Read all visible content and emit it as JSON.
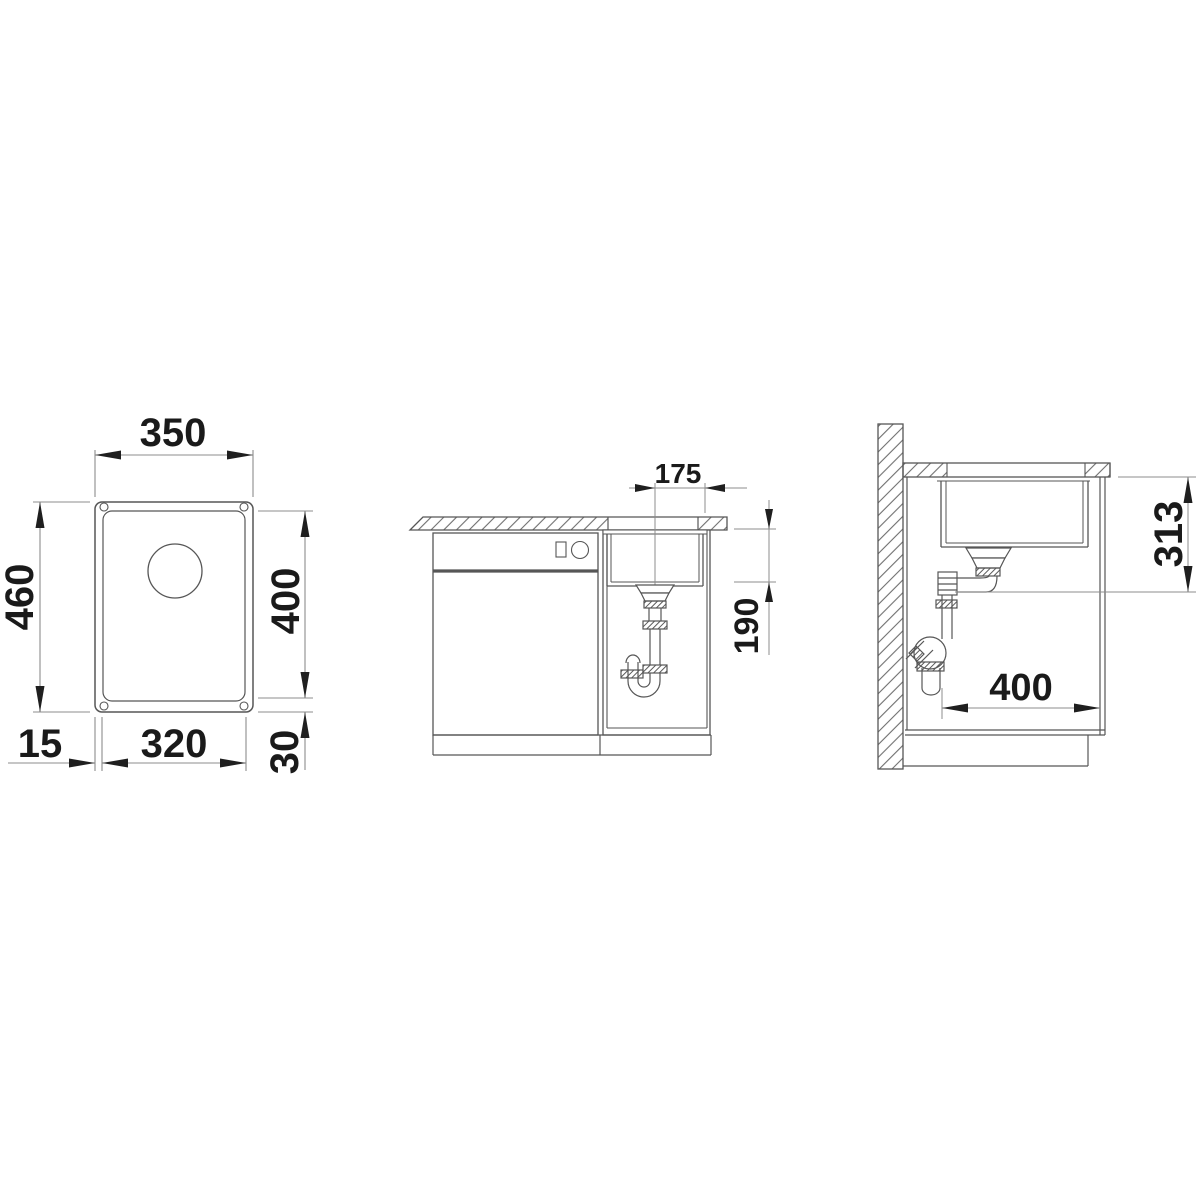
{
  "dimensions": {
    "top_view": {
      "overall_width": "350",
      "overall_depth": "460",
      "cutout_length": "400",
      "side_rim": "15",
      "bowl_width": "320",
      "front_rim": "30"
    },
    "front_view": {
      "drain_center_offset": "175",
      "bowl_depth": "190"
    },
    "side_view": {
      "drain_outlet_height": "313",
      "min_cabinet_depth": "400"
    }
  },
  "colors": {
    "background": "#ffffff",
    "object_line": "#565656",
    "dimension_line": "#8c8c8c",
    "text": "#1a1a1a"
  }
}
